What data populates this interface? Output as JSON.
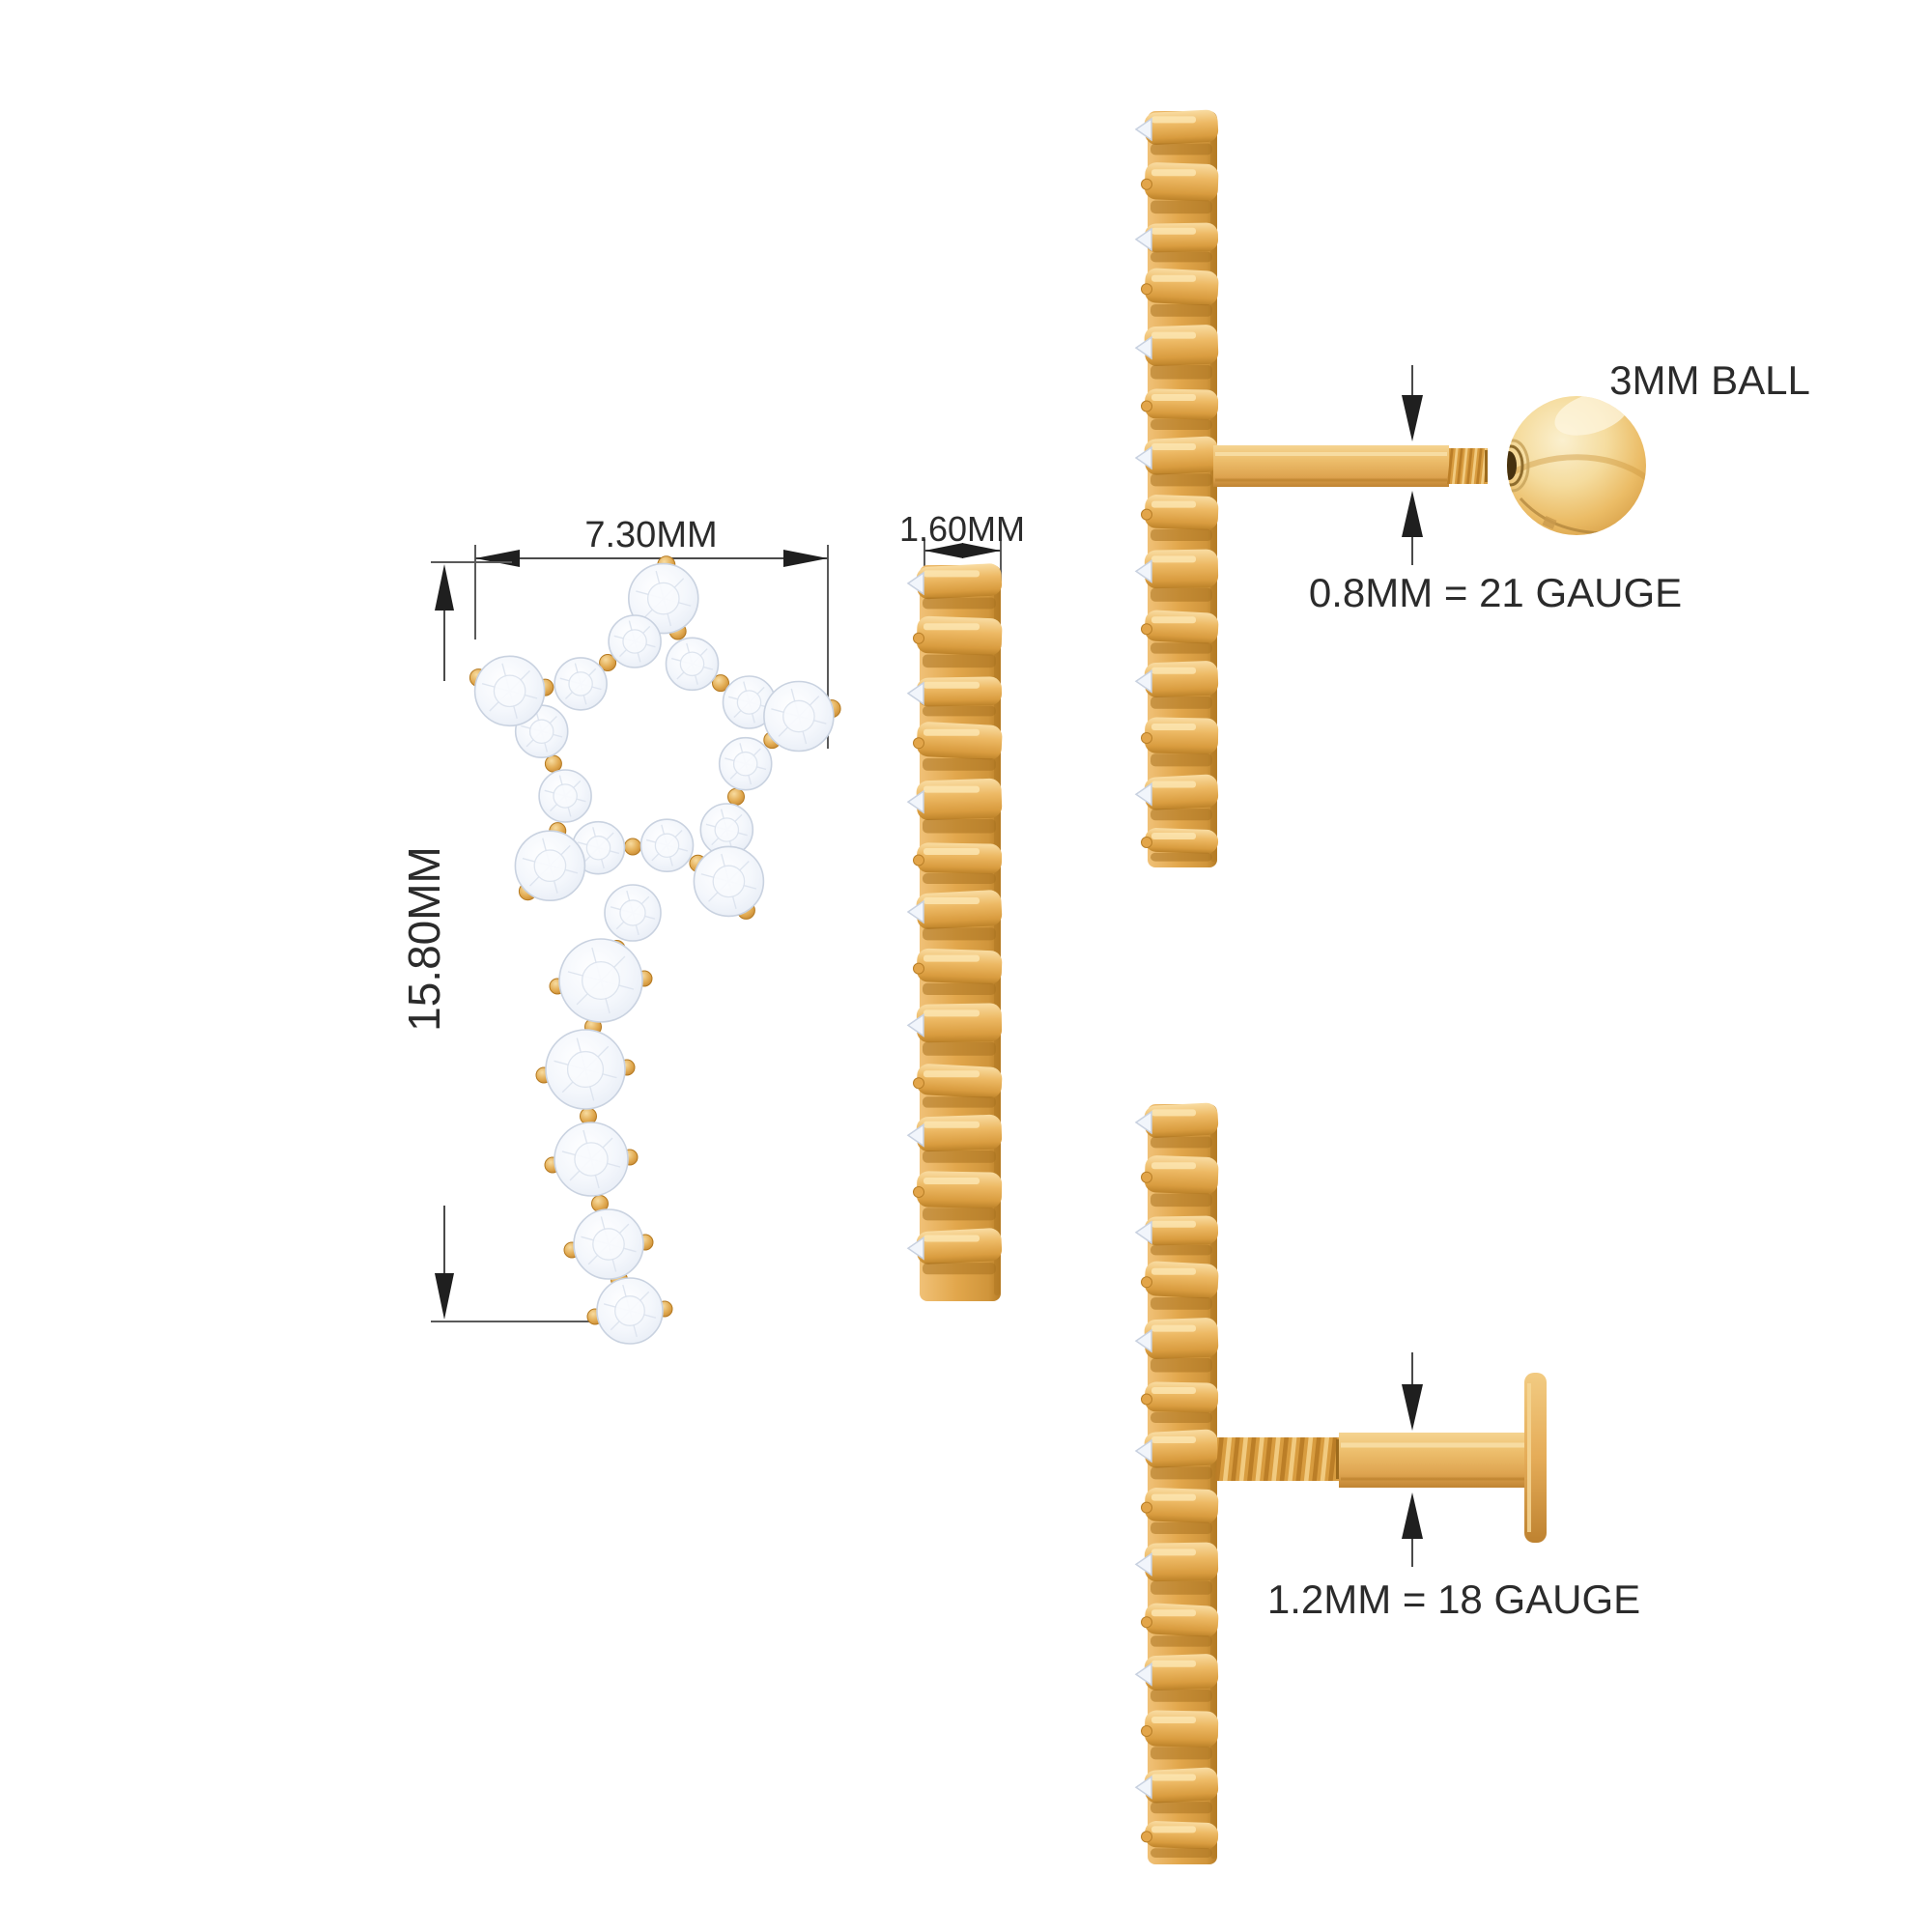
{
  "colors": {
    "background": "#FFFFFF",
    "gold": "#E2A74C",
    "gold_light": "#F6D28C",
    "gold_highlight": "#FCE9BD",
    "gold_dark": "#B97F28",
    "gold_deep": "#A06A1C",
    "diamond": "#F3F6FB",
    "diamond_edge": "#C9D2E0",
    "dimension_line": "#4A4A4A",
    "arrow": "#1F1F1F",
    "text": "#2B2B2B"
  },
  "views": {
    "front": {
      "width_label": "7.30MM",
      "height_label": "15.80MM"
    },
    "profile": {
      "depth_label": "1.60MM"
    },
    "ball_stud": {
      "ball_label": "3MM BALL",
      "post_label": "0.8MM = 21 GAUGE"
    },
    "labret_stud": {
      "post_label": "1.2MM = 18 GAUGE"
    }
  }
}
